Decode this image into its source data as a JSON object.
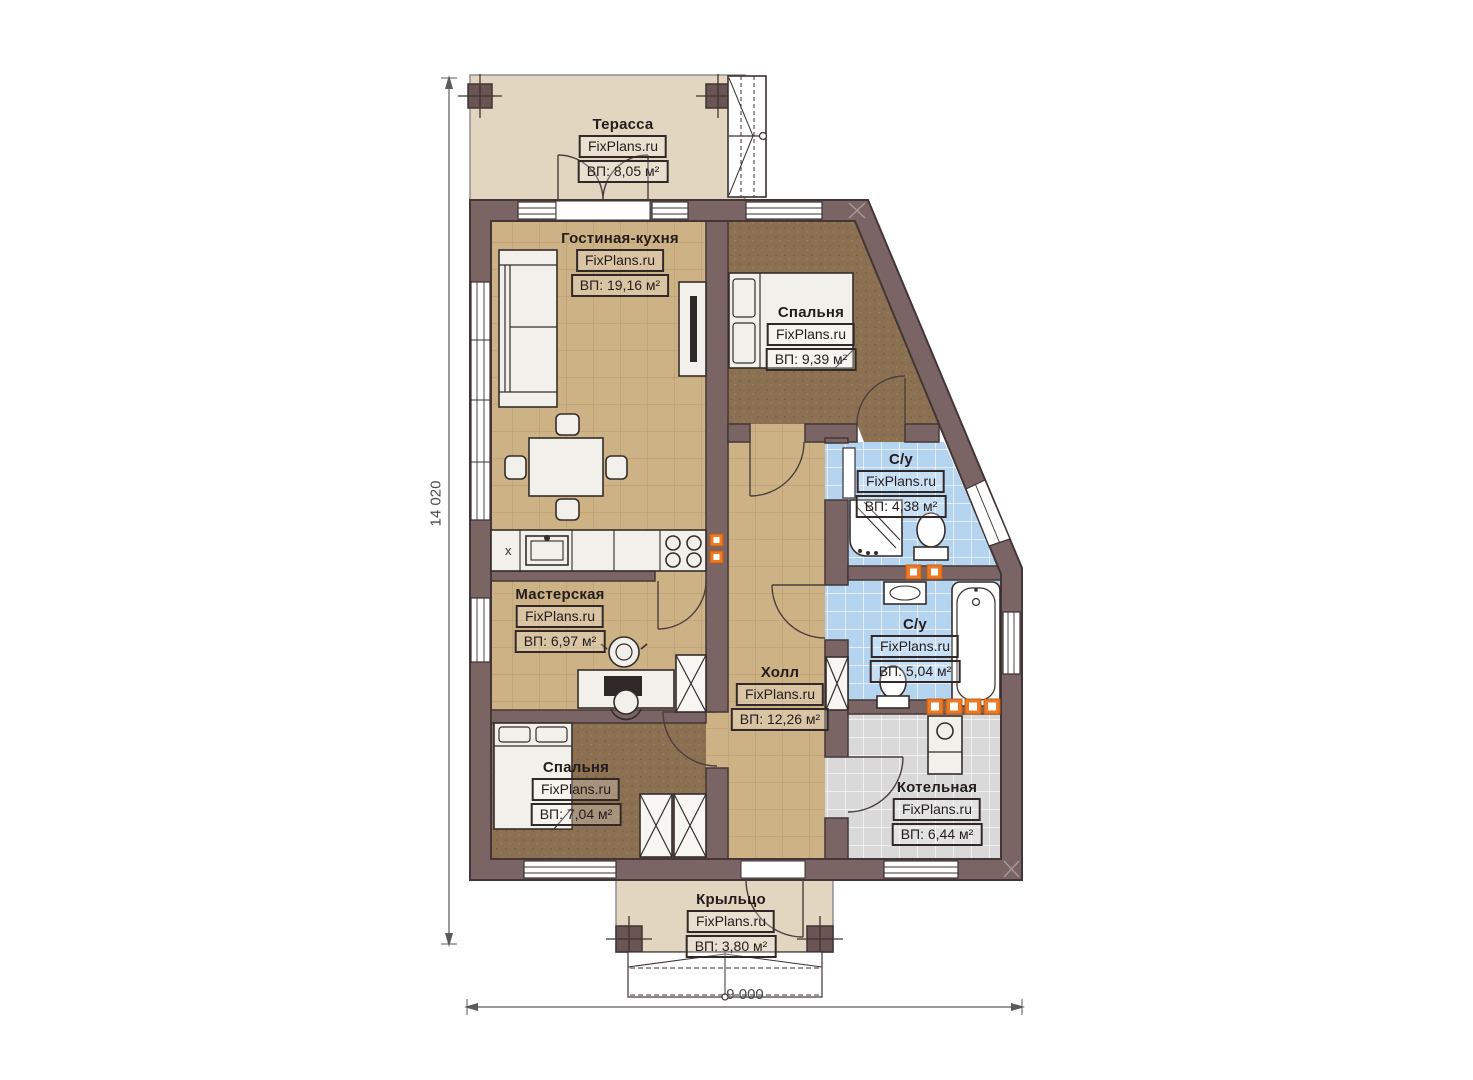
{
  "branding": {
    "watermark": "FixPlans.ru"
  },
  "rooms": [
    {
      "id": "terrace",
      "name": "Терасса",
      "area": "ВП: 8,05 м²"
    },
    {
      "id": "living-kitchen",
      "name": "Гостиная-кухня",
      "area": "ВП: 19,16 м²"
    },
    {
      "id": "bedroom-1",
      "name": "Спальня",
      "area": "ВП: 9,39 м²"
    },
    {
      "id": "bathroom-1",
      "name": "С/у",
      "area": "ВП: 4,38 м²"
    },
    {
      "id": "bathroom-2",
      "name": "С/у",
      "area": "ВП: 5,04 м²"
    },
    {
      "id": "workshop",
      "name": "Мастерская",
      "area": "ВП: 6,97 м²"
    },
    {
      "id": "hall",
      "name": "Холл",
      "area": "ВП: 12,26 м²"
    },
    {
      "id": "bedroom-2",
      "name": "Спальня",
      "area": "ВП: 7,04 м²"
    },
    {
      "id": "boiler-room",
      "name": "Котельная",
      "area": "ВП: 6,44 м²"
    },
    {
      "id": "porch",
      "name": "Крыльцо",
      "area": "ВП: 3,80 м²"
    }
  ],
  "dimensions": {
    "height_label": "14 020",
    "width_label": "9 000"
  },
  "marks": {
    "counter_x": "х"
  },
  "colors": {
    "wall": "#7b6464",
    "wall_outline": "#443636",
    "tan_floor": "#cdb285",
    "bedroom_floor": "#8b7051",
    "bath_floor": "#b5d4f0",
    "boiler_floor": "#d9d9d9",
    "terrace_floor": "#e2d6c0",
    "accent_orange": "#ed7a24"
  }
}
